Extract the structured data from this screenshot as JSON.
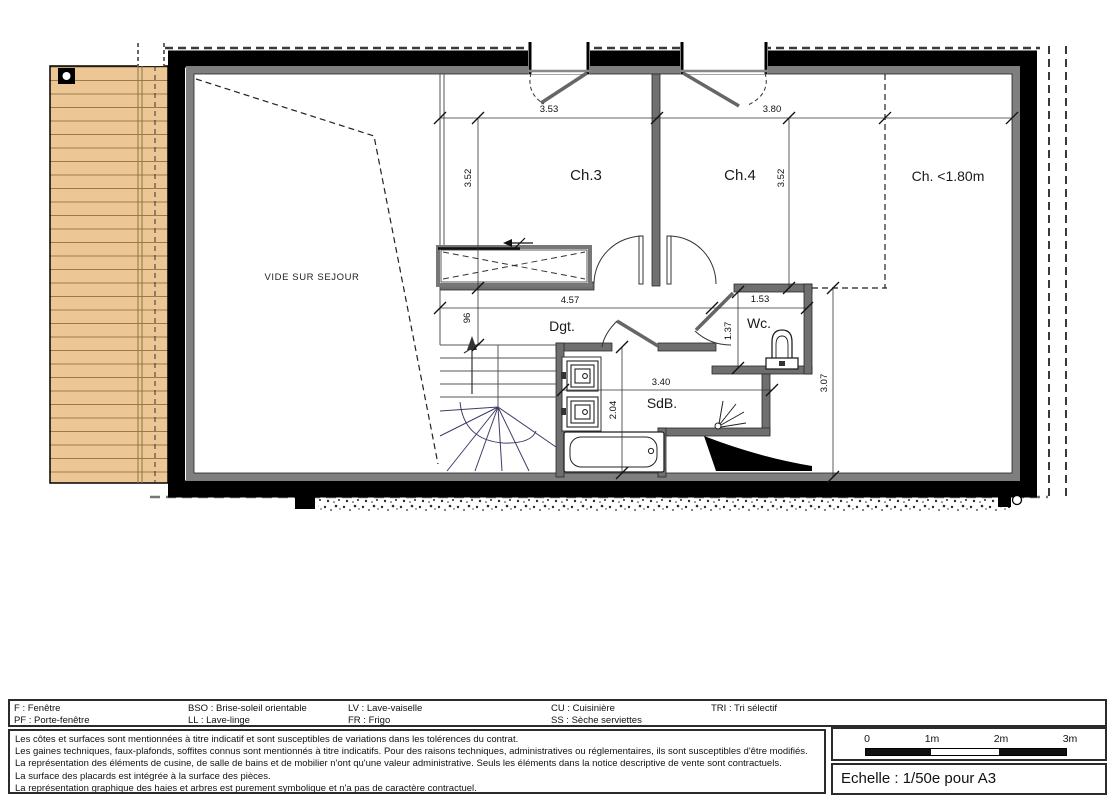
{
  "plan": {
    "rooms": {
      "ch3": "Ch.3",
      "ch4": "Ch.4",
      "ch_low": "Ch. <1.80m",
      "dgt": "Dgt.",
      "wc": "Wc.",
      "sdb": "SdB.",
      "vide": "VIDE SUR SEJOUR"
    },
    "dimensions": {
      "ch3_width": "3.53",
      "ch4_width": "3.80",
      "ch3_height": "3.52",
      "ch4_height": "3.52",
      "dgt_width": "4.57",
      "wc_width": "1.53",
      "dgt_depth": "96",
      "wc_height": "1.37",
      "sdb_width": "3.40",
      "sdb_height": "2.04",
      "right_zone_height": "3.07"
    }
  },
  "legend": {
    "columns": [
      {
        "line1": "F : Fenêtre",
        "line2": "PF : Porte-fenêtre"
      },
      {
        "line1": "BSO : Brise-soleil orientable",
        "line2": "LL : Lave-linge"
      },
      {
        "line1": "LV : Lave-vaiselle",
        "line2": "FR : Frigo"
      },
      {
        "line1": "CU : Cuisinière",
        "line2": "SS : Sèche serviettes"
      },
      {
        "line1": "TRI : Tri sélectif",
        "line2": ""
      }
    ]
  },
  "notes": {
    "lines": [
      "Les côtes et surfaces sont mentionnées à titre indicatif et sont susceptibles de variations dans les tolérences du contrat.",
      "Les gaines techniques, faux-plafonds, soffites connus sont mentionnés à titre indicatifs. Pour des raisons techniques, administratives ou réglementaires, ils sont susceptibles d'être modifiés.",
      "La représentation des éléments de cusine, de salle de bains et de mobilier n'ont qu'une valeur administrative. Seuls les éléments dans la notice descriptive de vente sont contractuels.",
      "La surface des placards est intégrée à la surface des pièces.",
      "La représentation graphique des haies et arbres est purement symbolique et n'a pas de caractère contractuel."
    ]
  },
  "scalebar": {
    "ticks": [
      "0",
      "1m",
      "2m",
      "3m"
    ],
    "caption": "Echelle : 1/50e pour A3"
  }
}
